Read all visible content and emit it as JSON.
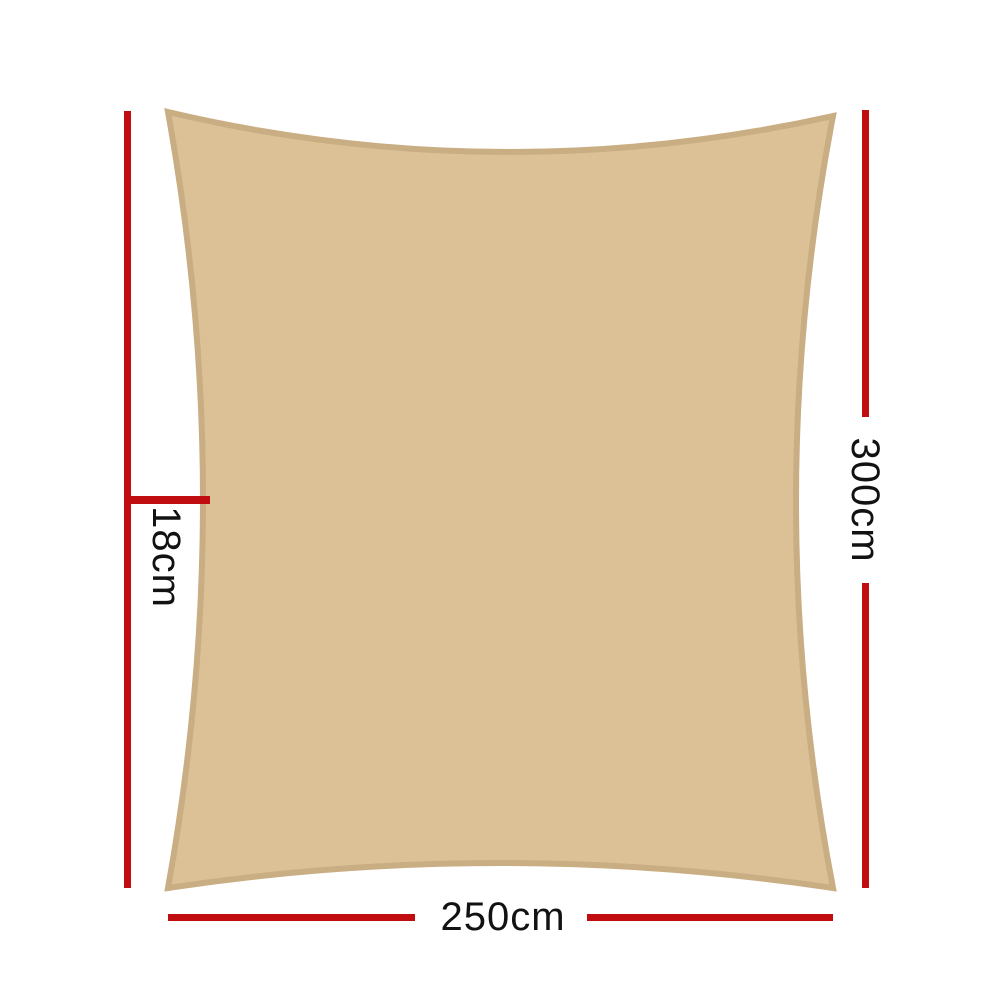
{
  "diagram": {
    "labels": {
      "left": "18cm",
      "right": "300cm",
      "bottom": "250cm"
    },
    "colors": {
      "dimension_line": "#c00d10",
      "sail_fill": "#dcc096",
      "sail_border": "#c9ad83",
      "label_text": "#121212",
      "background": "#ffffff"
    }
  }
}
